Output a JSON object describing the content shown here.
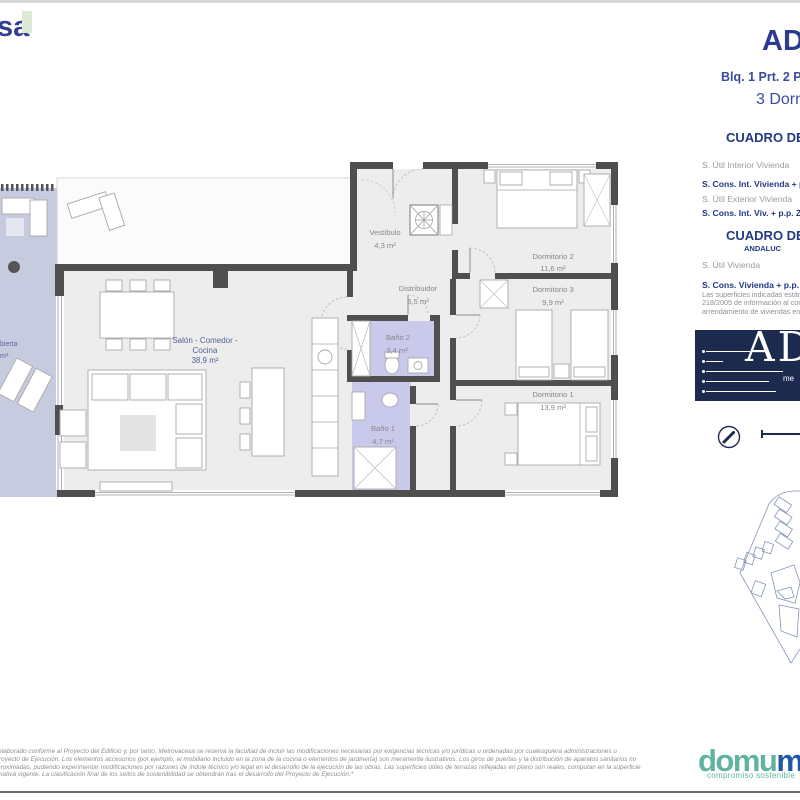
{
  "header": {
    "brand_partial": "sa",
    "project_title_partial": "ADA",
    "unit_line_partial": "Blq. 1 Prt. 2 P",
    "bedrooms_partial": "3 Dorm"
  },
  "surface_table_1": {
    "title_partial": "CUADRO DE S",
    "rows": [
      {
        "label": "S. Útil Interior Vivienda"
      },
      {
        "label": "S. Cons. Int. Vivienda + p.p. Z"
      },
      {
        "label": "S. Útil Exterior Vivienda"
      },
      {
        "label": "S. Cons. Int. Viv. + p.p. ZZCC"
      }
    ]
  },
  "surface_table_2": {
    "title_partial": "CUADRO DE S",
    "region_partial": "ANDALUC",
    "rows": [
      {
        "label": "S. Útil Vivienda"
      },
      {
        "label": "S. Cons. Vivienda + p.p. ZZ.C"
      }
    ],
    "note_lines": [
      "Las superficies indicadas están",
      "218/2005 de información al con",
      "arrendamiento de viviendas en"
    ]
  },
  "project_logo": {
    "letters_partial": "AD",
    "small_text_partial": "me",
    "background": "#1c2a4e"
  },
  "floorplan": {
    "colors": {
      "wall": "#4f4f4f",
      "room_fill": "#ededed",
      "terrace_fill": "#c7cbdf",
      "bathroom_fill": "#c9c9ec"
    },
    "rooms": [
      {
        "name": "Vestíbulo",
        "area": "4,3 m²"
      },
      {
        "name": "Distribuidor",
        "area": "6,5 m²"
      },
      {
        "name": "Dormitorio 2",
        "area": "11,6 m²"
      },
      {
        "name": "Dormitorio 3",
        "area": "9,9 m²"
      },
      {
        "name": "Dormitorio 1",
        "area": "13,9 m²"
      },
      {
        "name": "Baño 2",
        "area": "3,4 m²"
      },
      {
        "name": "Baño 1",
        "area": "4,7 m²"
      }
    ],
    "salon": {
      "line1": "Salón - Comedor -",
      "line2": "Cocina",
      "area": "38,9 m²"
    },
    "terrace_label_partial": {
      "line1": "bierta",
      "line2": "m²"
    }
  },
  "footer": {
    "disclaimer_lines": [
      "ido elaborado conforme al Proyecto del Edificio y, por tanto, Metrovacesa se reserva la facultad de incluir las modificaciones necesarias por exigencias técnicas y/o jurídicas u ordenadas por cualesquiera administraciones u",
      "al Proyecto de Ejecución. Los elementos accesorios (por ejemplo, el mobiliario incluido en la zona de la cocina o elementos de jardinería) son meramente ilustrativos. Los giros de puertas y la distribución de aparatos sanitarios no",
      "n aproximadas, pudiendo experimentar modificaciones por razones de índole técnico y/o legal en el desarrollo de la ejecución de las obras. Las superficies útiles de terrazas reflejadas en plano son reales, computan en la superficie",
      "normativa vigente. La clasificación final de los sellos de sostenibilidad se obtendrán tras el desarrollo del Proyecto de Ejecución.*"
    ],
    "brand": {
      "word_light": "domu",
      "word_bold": "m",
      "tagline": "compromiso sostenible"
    }
  }
}
